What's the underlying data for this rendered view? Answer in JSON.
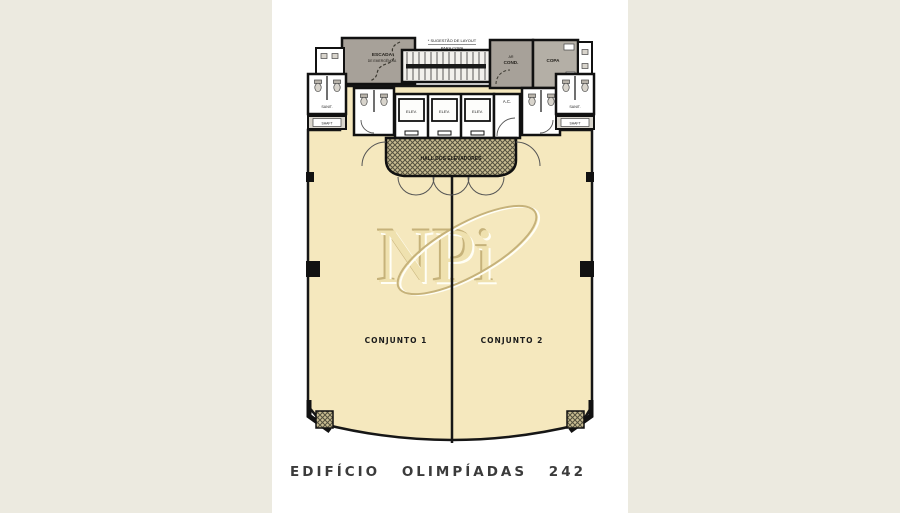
{
  "colors": {
    "page_bg": "#ECEAE0",
    "panel_bg": "#FFFFFF",
    "floor": "#F5E8BE",
    "service_room": "#A7A199",
    "copa_room": "#B4AFA6",
    "wall": "#161616",
    "hatch_base": "#C9BD92",
    "hatch_line": "#54503E",
    "title_color": "#3B3B3B",
    "watermark_main": "#EFE1AF",
    "watermark_shadow": "#C6B27A",
    "watermark_highlight": "#FFFEF5"
  },
  "header_note": {
    "line1": "* SUGESTÃO DE LAYOUT",
    "line2": "PARA COPA"
  },
  "rooms": {
    "stairs_line1": "ESCADA",
    "stairs_line2": "DE EMERGÊNCIA",
    "ac_unit_line1": "AR",
    "ac_unit_line2": "COND.",
    "copa": "COPA",
    "ac_small": "A.C.",
    "hall": "HALL DOS ELEVADORES",
    "sanit_left": "SANIT.",
    "sanit_right": "SANIT.",
    "shaft_left": "SHAFT",
    "shaft_right": "SHAFT"
  },
  "elevators": [
    "ELEV.",
    "ELEV.",
    "ELEV."
  ],
  "units": {
    "unit1": "CONJUNTO 1",
    "unit2": "CONJUNTO 2"
  },
  "watermark": {
    "text": "NPi"
  },
  "title": "EDIFÍCIO OLIMPÍADAS 242"
}
